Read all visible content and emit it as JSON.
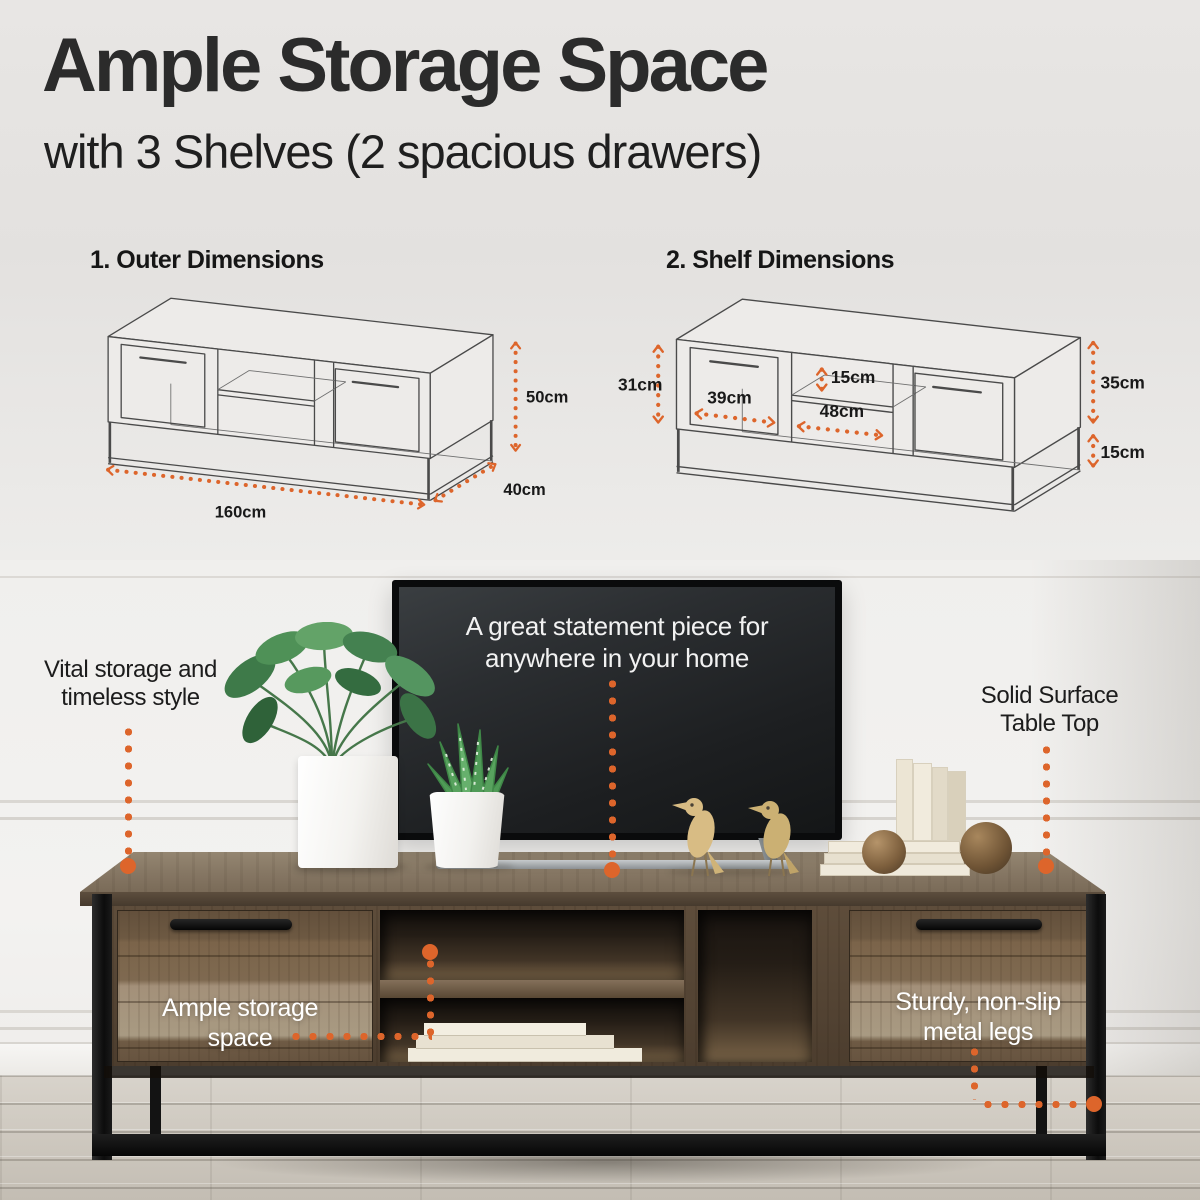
{
  "colors": {
    "accent": "#DD652B"
  },
  "header": {
    "title": "Ample Storage Space",
    "subtitle": "with 3 Shelves (2 spacious drawers)"
  },
  "diagrams": {
    "outer": {
      "label": "1. Outer Dimensions",
      "width": "160cm",
      "depth": "40cm",
      "height": "50cm"
    },
    "shelf": {
      "label": "2. Shelf Dimensions",
      "left_height": "31cm",
      "drawer_width": "39cm",
      "shelf_gap": "15cm",
      "middle_width": "48cm",
      "right_height": "35cm",
      "leg_height": "15cm"
    }
  },
  "photo": {
    "tv_caption": "A great statement piece for anywhere in your home",
    "callout_left": "Vital storage and timeless style",
    "callout_right": "Solid Surface Table Top",
    "callout_drawer_left": "Ample storage space",
    "callout_drawer_right": "Sturdy, non-slip metal legs"
  }
}
